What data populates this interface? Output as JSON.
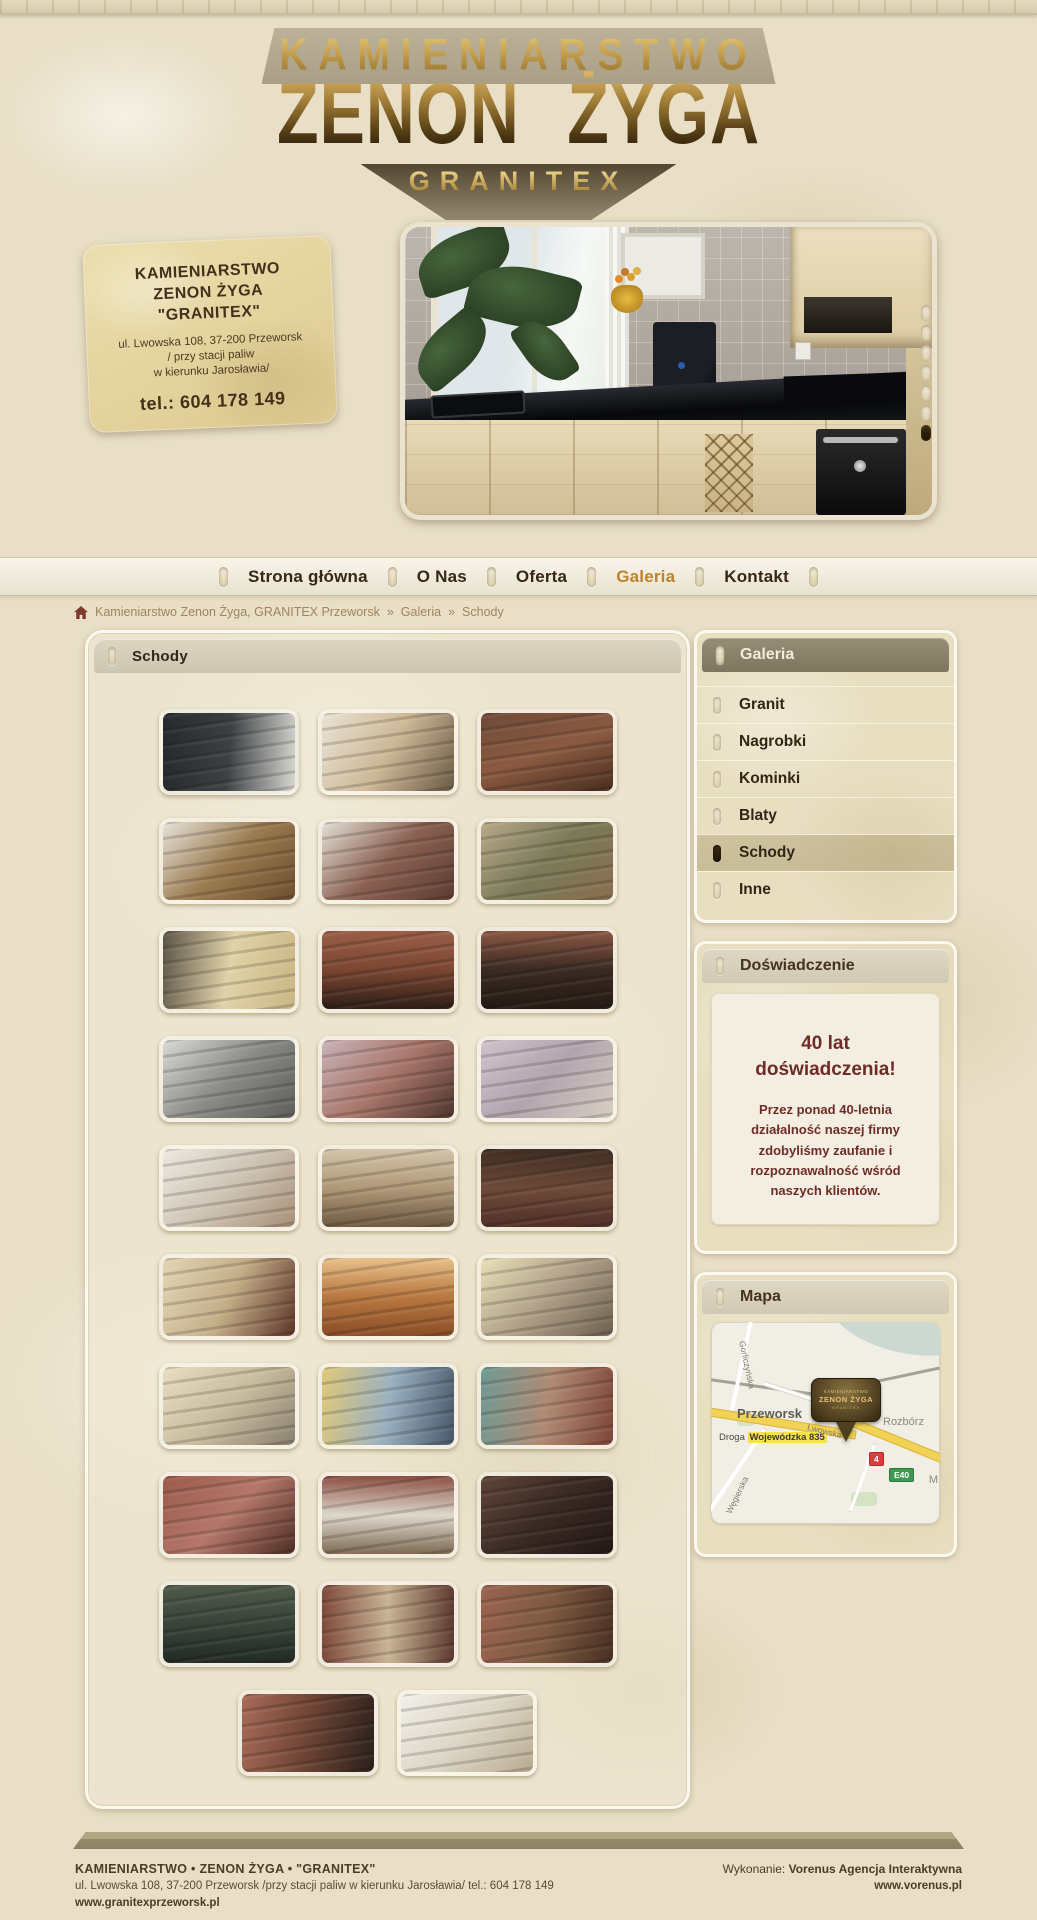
{
  "header": {
    "line1": "KAMIENIARSTWO",
    "line2": "ZENON ŻYGA",
    "line3": "GRANITEX"
  },
  "banner": {
    "card": {
      "title1": "KAMIENIARSTWO",
      "title2": "ZENON ŻYGA",
      "title3": "\"GRANITEX\"",
      "addr1": "ul. Lwowska 108, 37-200 Przeworsk",
      "addr2": "/ przy stacji paliw",
      "addr3": "w kierunku Jarosławia/",
      "phone": "tel.: 604 178 149"
    },
    "slider": {
      "dot_count": 7,
      "active_dot": 7
    }
  },
  "nav": {
    "items": [
      {
        "label": "Strona główna",
        "active": false
      },
      {
        "label": "O Nas",
        "active": false
      },
      {
        "label": "Oferta",
        "active": false
      },
      {
        "label": "Galeria",
        "active": true
      },
      {
        "label": "Kontakt",
        "active": false
      }
    ],
    "active_color": "#bc8329"
  },
  "breadcrumb": {
    "root": "Kamieniarstwo Zenon Żyga, GRANITEX Przeworsk",
    "sep1": "»",
    "galeria": "Galeria",
    "sep2": "»",
    "current": "Schody"
  },
  "gallery": {
    "title": "Schody",
    "thumbnails": [
      {
        "angle": 95,
        "colors": [
          "#26292b",
          "#3d4144",
          "#d8d8d2"
        ]
      },
      {
        "angle": 120,
        "colors": [
          "#e9e2d4",
          "#cdb896",
          "#6b5a44"
        ]
      },
      {
        "angle": 160,
        "colors": [
          "#6e4a38",
          "#8a5a40",
          "#4a2e20"
        ]
      },
      {
        "angle": 135,
        "colors": [
          "#e6e2da",
          "#9a7a4e",
          "#6e4f30"
        ]
      },
      {
        "angle": 135,
        "colors": [
          "#e3ded4",
          "#8a6152",
          "#5e3c32"
        ]
      },
      {
        "angle": 135,
        "colors": [
          "#b8a88a",
          "#7a7a58",
          "#8a6e4e"
        ]
      },
      {
        "angle": 100,
        "colors": [
          "#5a5246",
          "#e0d2a8",
          "#c9b684"
        ]
      },
      {
        "angle": 180,
        "colors": [
          "#9a5e48",
          "#7a4632",
          "#2e1e16"
        ]
      },
      {
        "angle": 180,
        "colors": [
          "#8a5844",
          "#3a2a22",
          "#241a14"
        ]
      },
      {
        "angle": 135,
        "colors": [
          "#d8d8d4",
          "#8a8a86",
          "#5e5e5a"
        ]
      },
      {
        "angle": 135,
        "colors": [
          "#c9b2b8",
          "#a8766a",
          "#4e342e"
        ]
      },
      {
        "angle": 135,
        "colors": [
          "#cfc2cc",
          "#b2a4ae",
          "#d8cfc2"
        ]
      },
      {
        "angle": 135,
        "colors": [
          "#ece8e0",
          "#cec4b4",
          "#a89078"
        ]
      },
      {
        "angle": 180,
        "colors": [
          "#d2c4a8",
          "#b09878",
          "#6e5a42"
        ]
      },
      {
        "angle": 180,
        "colors": [
          "#3e2c22",
          "#6e4a38",
          "#52302a"
        ]
      },
      {
        "angle": 115,
        "colors": [
          "#e2d4b4",
          "#c4ae88",
          "#5e3428"
        ]
      },
      {
        "angle": 180,
        "colors": [
          "#e8c08a",
          "#b87840",
          "#8a4e28"
        ]
      },
      {
        "angle": 135,
        "colors": [
          "#e8e0b8",
          "#b0a088",
          "#6e6050"
        ]
      },
      {
        "angle": 135,
        "colors": [
          "#e8ddc2",
          "#c9bc9e",
          "#8a8070"
        ]
      },
      {
        "angle": 100,
        "colors": [
          "#e0c878",
          "#9ab0c0",
          "#48586a"
        ]
      },
      {
        "angle": 100,
        "colors": [
          "#6e9a94",
          "#b08a74",
          "#7e4638"
        ]
      },
      {
        "angle": 135,
        "colors": [
          "#9a5a4a",
          "#b4776a",
          "#4e2e24"
        ]
      },
      {
        "angle": 180,
        "colors": [
          "#8a4e42",
          "#ded8cc",
          "#7e6a54"
        ]
      },
      {
        "angle": 135,
        "colors": [
          "#5e4438",
          "#3a2a24",
          "#241814"
        ]
      },
      {
        "angle": 180,
        "colors": [
          "#4e5a4a",
          "#39443a",
          "#222a24"
        ]
      },
      {
        "angle": 90,
        "colors": [
          "#7e4a3c",
          "#c9b494",
          "#5e3a30"
        ]
      },
      {
        "angle": 100,
        "colors": [
          "#9a6450",
          "#7e5a40",
          "#4a3024"
        ]
      },
      {
        "angle": 100,
        "colors": [
          "#a86a58",
          "#6e4434",
          "#2a201c"
        ]
      },
      {
        "angle": 135,
        "colors": [
          "#f2f0ea",
          "#ddd6c6",
          "#b8ab92"
        ]
      }
    ]
  },
  "sidebar": {
    "galeria": {
      "title": "Galeria",
      "items": [
        {
          "label": "Granit",
          "active": false
        },
        {
          "label": "Nagrobki",
          "active": false
        },
        {
          "label": "Kominki",
          "active": false
        },
        {
          "label": "Blaty",
          "active": false
        },
        {
          "label": "Schody",
          "active": true
        },
        {
          "label": "Inne",
          "active": false
        }
      ]
    },
    "experience": {
      "title": "Doświadczenie",
      "headline": "40 lat\ndoświadczenia!",
      "body": "Przez ponad 40-letnia działalność naszej firmy zdobyliśmy zaufanie i rozpoznawalność wśród naszych klientów."
    },
    "map": {
      "title": "Mapa",
      "labels": {
        "city": "Przeworsk",
        "village": "Rozbórz",
        "road_prefix": "Droga",
        "road_highlight": "Wojewódzka 835",
        "street_lwowska": "Lwowska",
        "street_wegierska": "Węgierska",
        "street_gorliczynska": "Gorliczyńska",
        "edge_label": "M",
        "badge_national": "4",
        "badge_euro": "E40"
      },
      "pin": {
        "line1": "KAMIENIARSTWO",
        "line2": "ZENON ŻYGA",
        "line3": "GRANITEX"
      }
    }
  },
  "footer": {
    "company": "KAMIENIARSTWO • ZENON ŻYGA • \"GRANITEX\"",
    "address": "ul. Lwowska 108, 37-200 Przeworsk /przy stacji paliw w kierunku Jarosławia/ tel.: 604 178 149",
    "website": "www.granitexprzeworsk.pl",
    "credit_label": "Wykonanie:",
    "credit_name": "Vorenus Agencja Interaktywna",
    "credit_site": "www.vorenus.pl"
  }
}
